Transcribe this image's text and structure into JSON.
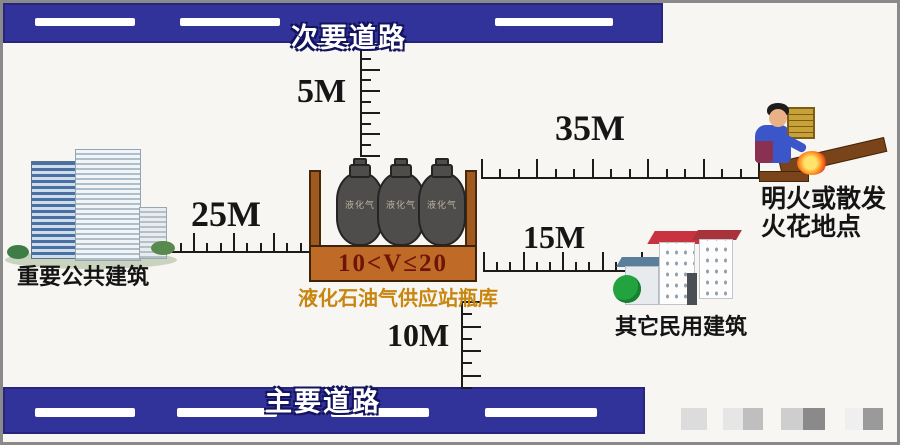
{
  "roads": {
    "secondary_label": "次要道路",
    "main_label": "主要道路"
  },
  "distances": {
    "to_secondary_road": "5M",
    "to_public_building": "25M",
    "to_flame_point": "35M",
    "to_civil_building": "15M",
    "to_main_road": "10M"
  },
  "station": {
    "volume_range": "10<V≤20",
    "caption": "液化石油气供应站瓶库",
    "cylinder_text": "液化气"
  },
  "labels": {
    "public_building": "重要公共建筑",
    "civil_building": "其它民用建筑",
    "flame_line1": "明火或散发",
    "flame_line2": "火花地点"
  },
  "colors": {
    "road": "#32329b",
    "road_marking": "#ffffff",
    "container_wall": "#a05a20",
    "container_band": "#c06a28",
    "volume_text": "#6f1408",
    "caption_text": "#c8860f",
    "cylinder": "#4f4d4b",
    "flame": "#ff8c1e"
  }
}
